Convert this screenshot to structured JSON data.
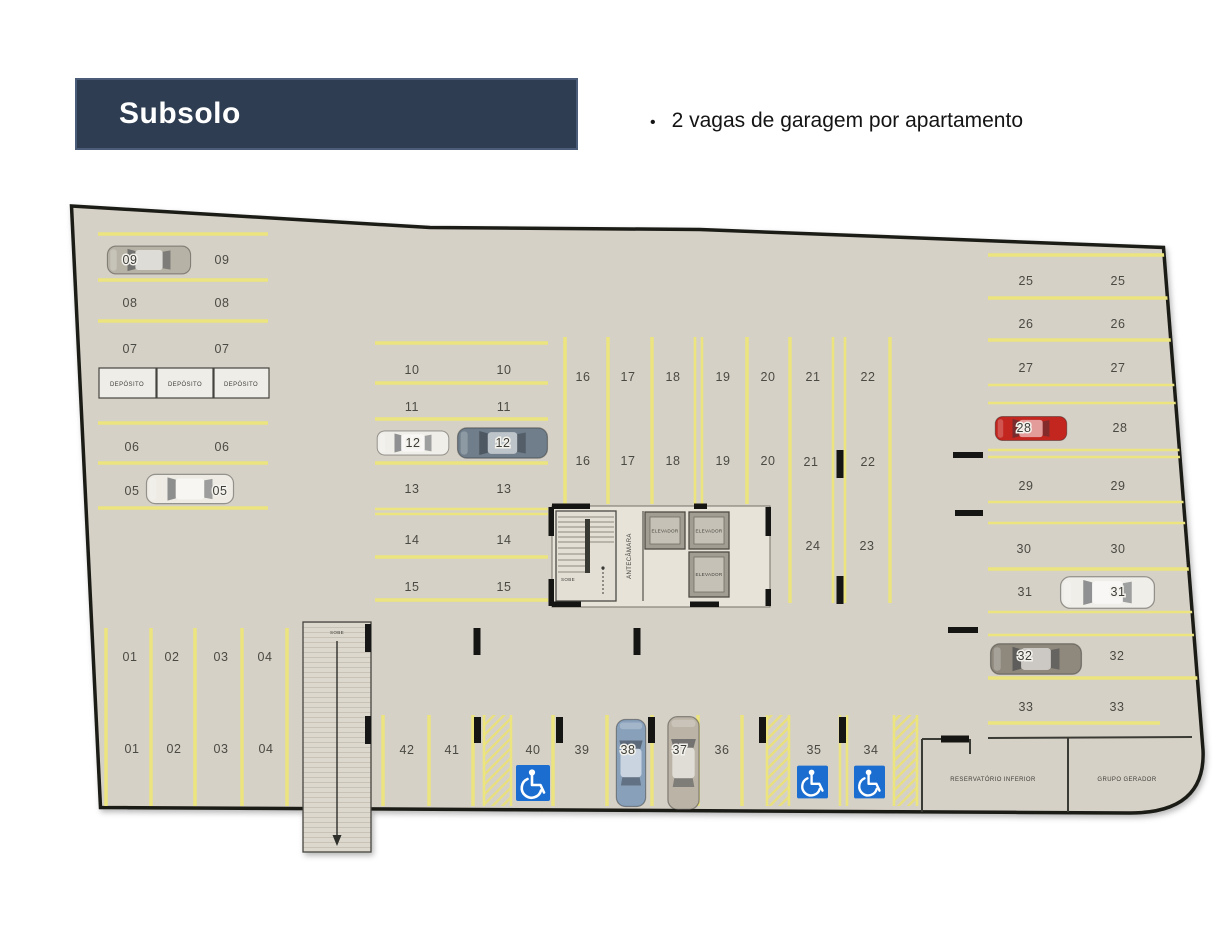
{
  "header": {
    "title": "Subsolo",
    "bullet": "•",
    "bullet_text": "2 vagas de garagem por apartamento"
  },
  "plan": {
    "rooms": {
      "deposito": "DEPÓSITO",
      "elevador": "ELEVADOR",
      "antecamara": "ANTECÂMARA",
      "reservatorio_inferior": "RESERVATÓRIO INFERIOR",
      "grupo_gerador": "GRUPO GERADOR",
      "sobe": "SOBE"
    },
    "spots": {
      "s01": "01",
      "s02": "02",
      "s03": "03",
      "s04": "04",
      "s05": "05",
      "s06": "06",
      "s07": "07",
      "s08": "08",
      "s09": "09",
      "s10": "10",
      "s11": "11",
      "s12": "12",
      "s13": "13",
      "s14": "14",
      "s15": "15",
      "s16": "16",
      "s17": "17",
      "s18": "18",
      "s19": "19",
      "s20": "20",
      "s21": "21",
      "s22": "22",
      "s23": "23",
      "s24": "24",
      "s25": "25",
      "s26": "26",
      "s27": "27",
      "s28": "28",
      "s29": "29",
      "s30": "30",
      "s31": "31",
      "s32": "32",
      "s33": "33",
      "s34": "34",
      "s35": "35",
      "s36": "36",
      "s37": "37",
      "s38": "38",
      "s39": "39",
      "s40": "40",
      "s41": "41",
      "s42": "42"
    },
    "colors": {
      "accent_navy": "#2e3d52",
      "floor": "#d6d1c6",
      "line_yellow": "#ece47e",
      "handicap_blue": "#1b6ed0",
      "car_09": "#b7b2a6",
      "car_05": "#edebe3",
      "car_12_white": "#f0eee8",
      "car_12_gray": "#6f7e8a",
      "car_28": "#c3251f",
      "car_31": "#f0eee9",
      "car_32": "#8e887d",
      "car_38": "#88a0ba",
      "car_37": "#bab3a6"
    }
  }
}
